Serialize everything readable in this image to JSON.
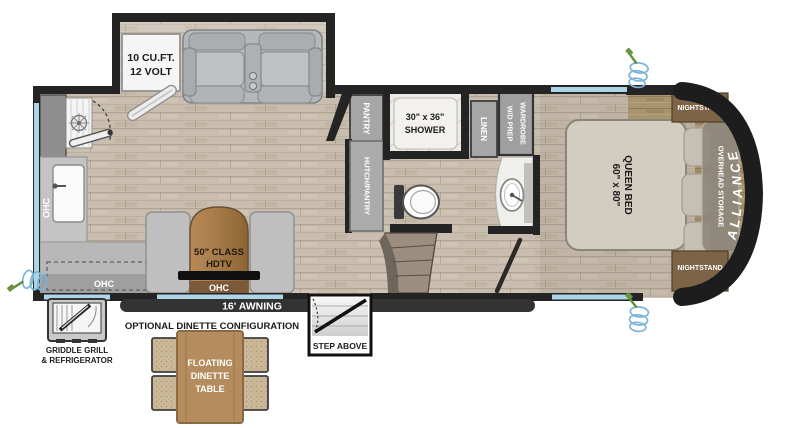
{
  "floorplan": {
    "brand": "ALLIANCE",
    "slide_left": {
      "fridge_line1": "10 CU.FT.",
      "fridge_line2": "12 VOLT"
    },
    "kitchen": {
      "ohc_wall": "OHC",
      "ohc_lower": "OHC"
    },
    "entertainment": {
      "tv_line1": "50\" CLASS",
      "tv_line2": "HDTV",
      "ohc": "OHC"
    },
    "bath": {
      "pantry": "PANTRY",
      "hutch": "HUTCH/PANTRY",
      "shower_line1": "30\" x 36\"",
      "shower_line2": "SHOWER",
      "linen": "LINEN",
      "wardrobe_line1": "WARDROBE",
      "wardrobe_line2": "W/D PREP"
    },
    "bedroom": {
      "bed_line1": "QUEEN BED",
      "bed_line2": "60\" x 80\"",
      "overhead_storage": "OVERHEAD STORAGE",
      "nightstand_top": "NIGHTSTAND",
      "nightstand_bottom": "NIGHTSTAND"
    },
    "exterior": {
      "awning": "16' AWNING",
      "step": "STEP ABOVE",
      "griddle_line1": "GRIDDLE GRILL",
      "griddle_line2": "& REFRIGERATOR",
      "dinette_heading": "OPTIONAL DINETTE CONFIGURATION",
      "dinette_line1": "FLOATING",
      "dinette_line2": "DINETTE",
      "dinette_line3": "TABLE"
    }
  },
  "colors": {
    "wall": "#242424",
    "window": "#aed4e8",
    "awning_bar": "#333333",
    "wood_floor": "#c8bdae",
    "cap_wood": "#a8946f",
    "table_wood": "#b48c5e",
    "cabinet_gray": "#a6a6a6",
    "hose_blue": "#7db4d8",
    "hose_green": "#5d8f3c"
  }
}
